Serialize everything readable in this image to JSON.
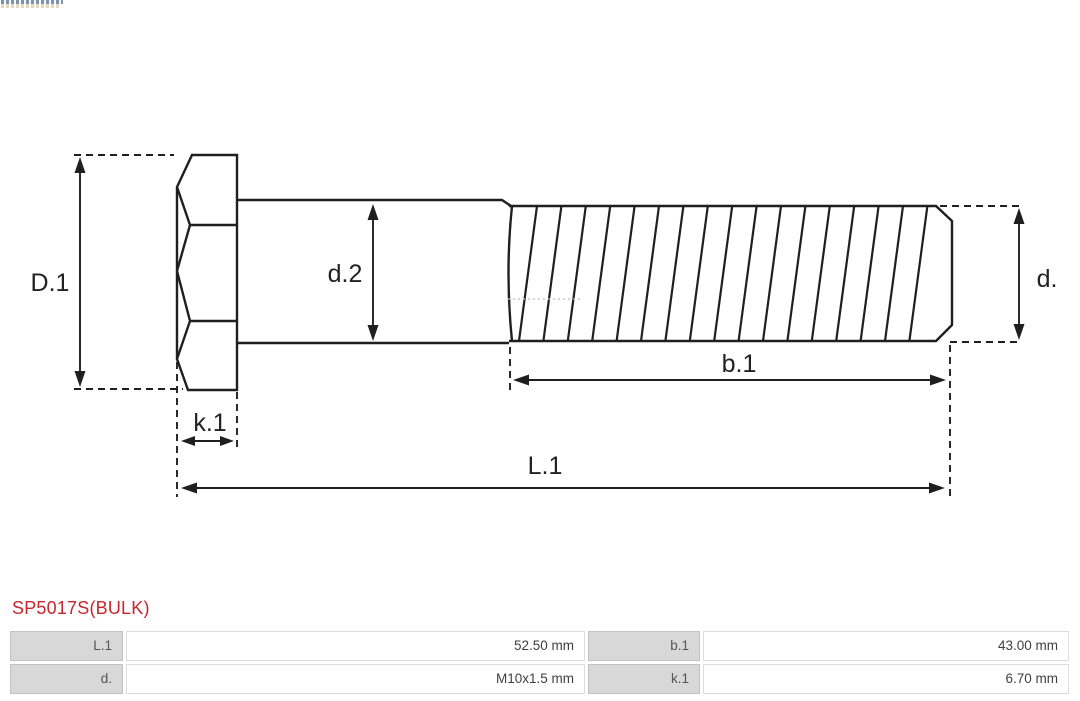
{
  "page": {
    "background": "#ffffff",
    "line_color": "#1f1f1f",
    "accent_color": "#c8262c"
  },
  "diagram": {
    "type": "technical-drawing-bolt",
    "labels": {
      "D1": "D.1",
      "d2": "d.2",
      "d": "d.",
      "b1": "b.1",
      "k1": "k.1",
      "L1": "L.1"
    },
    "hatch": {
      "count": 17,
      "start_x": 537,
      "spacing": 24.4,
      "slant_dx": -18,
      "top_y": 206,
      "bottom_y": 341
    }
  },
  "part_number": {
    "text": "SP5017S(BULK)",
    "color": "#c8262c"
  },
  "spec_table": {
    "label_bg": "#d8d8d8",
    "rows": [
      [
        "L.1",
        "52.50 mm",
        "b.1",
        "43.00 mm"
      ],
      [
        "d.",
        "M10x1.5 mm",
        "k.1",
        "6.70 mm"
      ]
    ]
  }
}
